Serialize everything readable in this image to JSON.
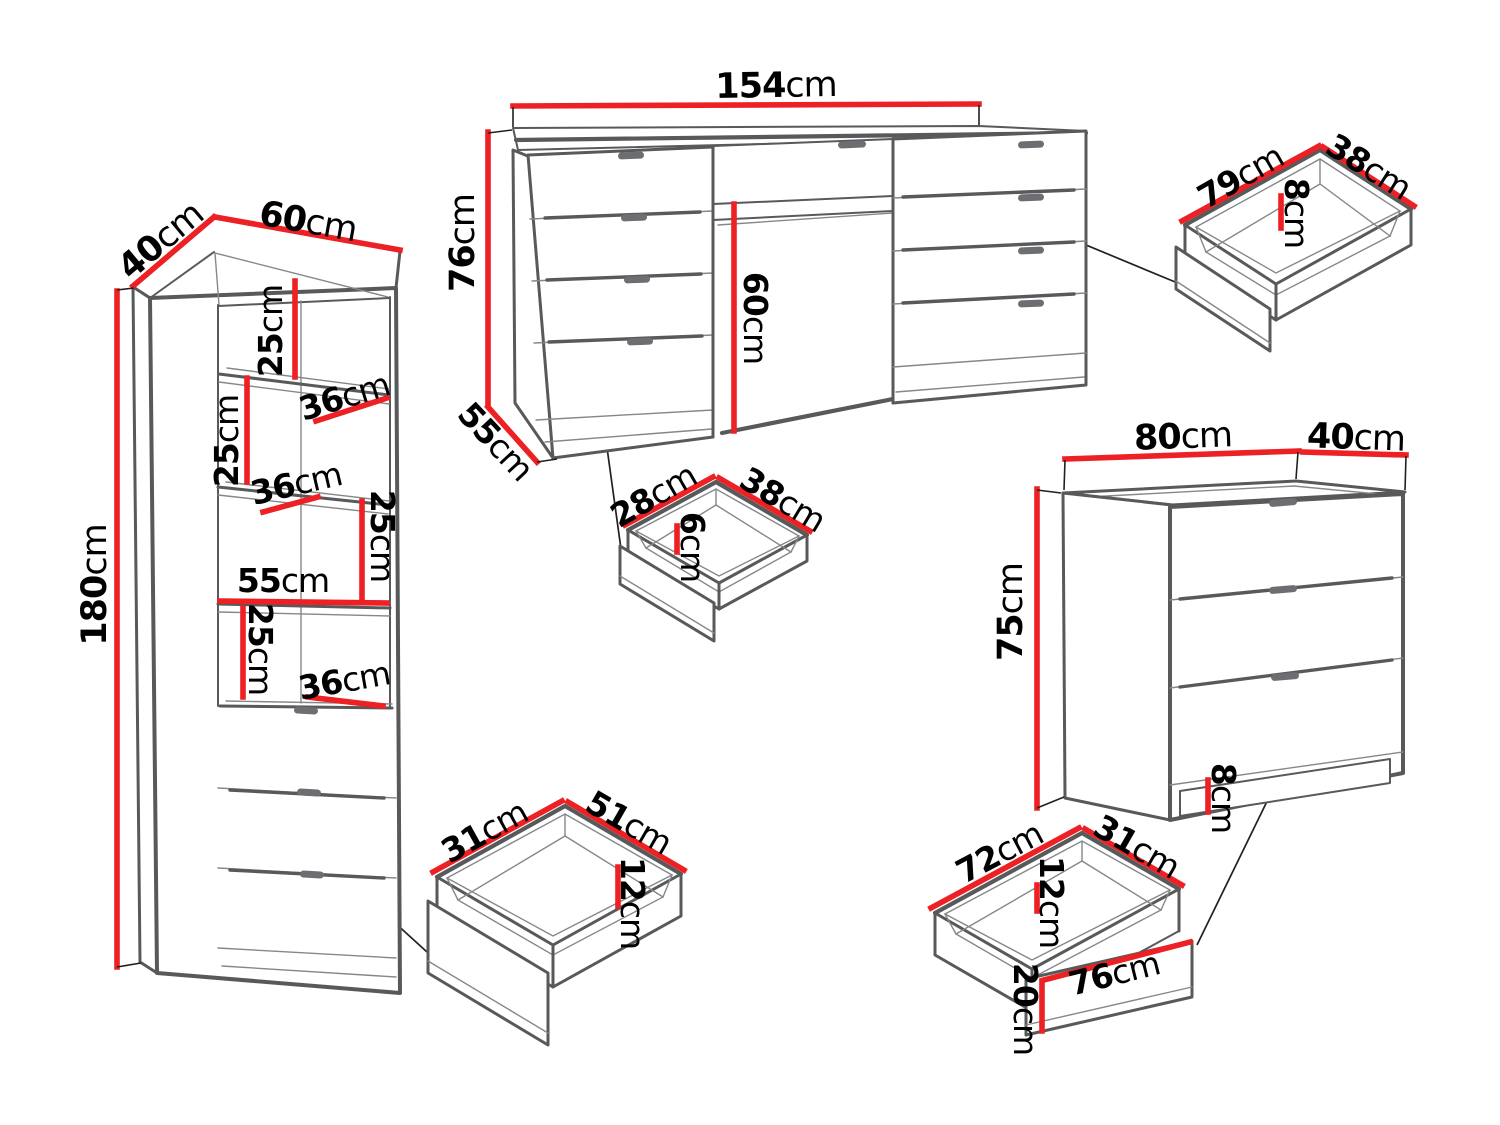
{
  "diagram": {
    "kind": "furniture-dimension-diagram",
    "unit": "cm",
    "colors": {
      "background": "#ffffff",
      "dimension_line": "#ed2024",
      "outline": "#58595b",
      "detail_line": "#85878a",
      "label_text": "#000000",
      "handle": "#6d6e71"
    }
  },
  "cabinet": {
    "depth": {
      "num": "40",
      "unit": "cm"
    },
    "width": {
      "num": "60",
      "unit": "cm"
    },
    "height": {
      "num": "180",
      "unit": "cm"
    },
    "gap1": {
      "num": "25",
      "unit": "cm"
    },
    "shelf1_depth": {
      "num": "36",
      "unit": "cm"
    },
    "gap2": {
      "num": "25",
      "unit": "cm"
    },
    "shelf2_depth": {
      "num": "36",
      "unit": "cm"
    },
    "gap3": {
      "num": "25",
      "unit": "cm"
    },
    "interior_width": {
      "num": "55",
      "unit": "cm"
    },
    "gap4": {
      "num": "25",
      "unit": "cm"
    },
    "shelf3_depth": {
      "num": "36",
      "unit": "cm"
    }
  },
  "desk": {
    "width": {
      "num": "154",
      "unit": "cm"
    },
    "height": {
      "num": "76",
      "unit": "cm"
    },
    "depth": {
      "num": "55",
      "unit": "cm"
    },
    "knee_clearance": {
      "num": "60",
      "unit": "cm"
    }
  },
  "desk_drawer": {
    "width": {
      "num": "79",
      "unit": "cm"
    },
    "depth": {
      "num": "38",
      "unit": "cm"
    },
    "height": {
      "num": "8",
      "unit": "cm"
    }
  },
  "small_drawer": {
    "width": {
      "num": "28",
      "unit": "cm"
    },
    "depth": {
      "num": "38",
      "unit": "cm"
    },
    "height": {
      "num": "6",
      "unit": "cm"
    }
  },
  "cabinet_drawer": {
    "depth": {
      "num": "31",
      "unit": "cm"
    },
    "width": {
      "num": "51",
      "unit": "cm"
    },
    "height": {
      "num": "12",
      "unit": "cm"
    }
  },
  "chest": {
    "width": {
      "num": "80",
      "unit": "cm"
    },
    "depth": {
      "num": "40",
      "unit": "cm"
    },
    "height": {
      "num": "75",
      "unit": "cm"
    },
    "plinth_height": {
      "num": "8",
      "unit": "cm"
    }
  },
  "chest_drawer": {
    "width": {
      "num": "72",
      "unit": "cm"
    },
    "depth": {
      "num": "31",
      "unit": "cm"
    },
    "height": {
      "num": "12",
      "unit": "cm"
    },
    "front_height": {
      "num": "20",
      "unit": "cm"
    },
    "front_width": {
      "num": "76",
      "unit": "cm"
    }
  }
}
